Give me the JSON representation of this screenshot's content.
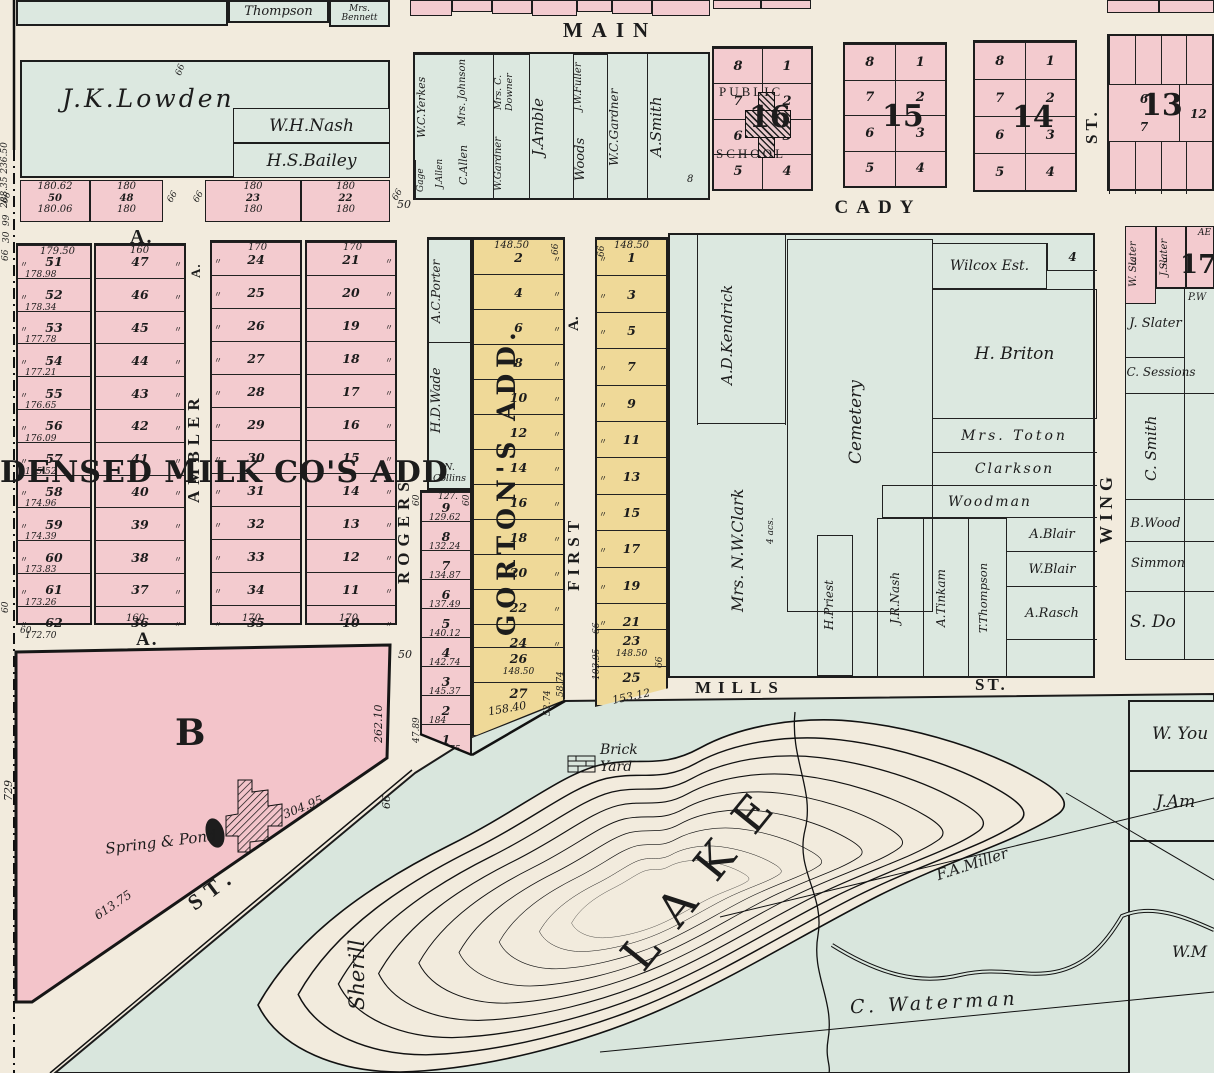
{
  "streets": {
    "main": "MAIN",
    "cady": "CADY",
    "mills": "MILLS",
    "mills_st": "ST.",
    "st13": "ST.",
    "wing": "WING",
    "rogers": "ROGERS",
    "ambler": "AMBLER",
    "ambler_a": "A.",
    "first": "FIRST",
    "first_a": "A.",
    "a_top": "A.",
    "a_bottom": "A.",
    "b_st": "ST."
  },
  "top": {
    "thompson": "Thompson",
    "bennett": "Mrs. Bennett"
  },
  "lowden": {
    "main": "J.K.Lowden",
    "nash": "W.H.Nash",
    "bailey": "H.S.Bailey",
    "lots": [
      {
        "t": "180.62",
        "n": "50",
        "b": "180.06"
      },
      {
        "t": "180",
        "n": "48",
        "b": "180"
      },
      {
        "t": "180",
        "n": "23",
        "b": "180"
      },
      {
        "t": "180",
        "n": "22",
        "b": "180"
      }
    ],
    "m66a": "66",
    "m66b": "66",
    "m66c": "66",
    "m66d": "66",
    "m66e": "66",
    "m50": "50"
  },
  "mainBlock": {
    "yerkes": "W.C.Yerkes",
    "gage": "Gage",
    "jallen": "J.Allen",
    "johnson": "Mrs. Johnson",
    "callen": "C.Allen",
    "downer": "Mrs. C. Downer",
    "wgardner": "W.Gardner",
    "amble": "J.Amble",
    "fuller": "J.W.Fuller",
    "woods": "Woods",
    "wcgardner": "W.C.Gardner",
    "smith": "A.Smith",
    "n8": "8"
  },
  "block16": {
    "big": "16",
    "pub": "PUBLIC",
    "sch": "SCHOOL",
    "rows": [
      [
        "8",
        "1"
      ],
      [
        "7",
        "2"
      ],
      [
        "6",
        "3"
      ],
      [
        "5",
        "4"
      ]
    ]
  },
  "block15": {
    "big": "15",
    "rows": [
      [
        "8",
        "1"
      ],
      [
        "7",
        "2"
      ],
      [
        "6",
        "3"
      ],
      [
        "5",
        "4"
      ]
    ]
  },
  "block14": {
    "big": "14",
    "rows": [
      [
        "8",
        "1"
      ],
      [
        "7",
        "2"
      ],
      [
        "6",
        "3"
      ],
      [
        "5",
        "4"
      ]
    ]
  },
  "block13": {
    "big": "13",
    "top": [
      "5",
      "4",
      "3",
      "2"
    ],
    "m6": "6",
    "m7": "7",
    "m12": "12",
    "bot": [
      "8",
      "9",
      "10",
      "11"
    ]
  },
  "left": {
    "col1Top": "179.50",
    "col1": [
      {
        "n": "51",
        "m": "178.98"
      },
      {
        "n": "52",
        "m": "178.34"
      },
      {
        "n": "53",
        "m": "177.78"
      },
      {
        "n": "54",
        "m": "177.21"
      },
      {
        "n": "55",
        "m": "176.65"
      },
      {
        "n": "56",
        "m": "176.09"
      },
      {
        "n": "57",
        "m": "175.52"
      },
      {
        "n": "58",
        "m": "174.96"
      },
      {
        "n": "59",
        "m": "174.39"
      },
      {
        "n": "60",
        "m": "173.83"
      },
      {
        "n": "61",
        "m": "173.26"
      },
      {
        "n": "62",
        "m": "172.70"
      }
    ],
    "col2Top": "160",
    "col2Bottom": "160",
    "col2": [
      "47",
      "46",
      "45",
      "44",
      "43",
      "42",
      "41",
      "40",
      "39",
      "38",
      "37",
      "36"
    ],
    "col3Top": "170",
    "col3Bottom": "170",
    "col3": [
      "24",
      "25",
      "26",
      "27",
      "28",
      "29",
      "30",
      "31",
      "32",
      "33",
      "34",
      "35"
    ],
    "col4Top": "170",
    "col4Bottom": "170",
    "col4": [
      "21",
      "20",
      "19",
      "18",
      "17",
      "16",
      "15",
      "14",
      "13",
      "12",
      "11",
      "10"
    ],
    "bigAdd": "DENSED MILK CO'S ADD"
  },
  "edge": {
    "a": "288.35 236.50",
    "b": "99",
    "c": "30",
    "d": "66",
    "e": "66",
    "f": "60",
    "g": "60"
  },
  "porterStrip": {
    "porter": "A.C.Porter",
    "wade": "H.D.Wade",
    "collins": "N. Collins",
    "lots": [
      {
        "t": "127.",
        "n": "9",
        "m": "129.62"
      },
      {
        "n": "8",
        "m": "132.24"
      },
      {
        "n": "7",
        "m": "134.87"
      },
      {
        "n": "6",
        "m": "137.49"
      },
      {
        "n": "5",
        "m": "140.12"
      },
      {
        "n": "4",
        "m": "142.74"
      },
      {
        "n": "3",
        "m": "145.37"
      },
      {
        "n": "2",
        "m": "184"
      },
      {
        "n": "1",
        "m": "155.75"
      }
    ],
    "m4789": "47.89",
    "m60": "60",
    "m60b": "60"
  },
  "gortons": {
    "name": "GORTON'S ADD.",
    "top": "148.50",
    "m66": "66",
    "lots": [
      "2",
      "4",
      "6",
      "8",
      "10",
      "12",
      "14",
      "16",
      "18",
      "20",
      "22",
      "24"
    ],
    "lot26": "26",
    "m26": "148.50",
    "lot27": "27",
    "m27": "158.40",
    "m5874": "58.74",
    "m5274": "52.74"
  },
  "strip2": {
    "top": "148.50",
    "m66l": "66",
    "lots": [
      "1",
      "3",
      "5",
      "7",
      "9",
      "11",
      "13",
      "15",
      "17",
      "19",
      "21"
    ],
    "lot23": "23",
    "m23": "148.50",
    "m66b": "66",
    "lot25": "25",
    "m25": "153.12",
    "m10395": "103.95",
    "m66r": "66"
  },
  "estate": {
    "kendrick": "A.D.Kendrick",
    "cemetery": "Cemetery",
    "clark": "Mrs. N.W.Clark",
    "acs": "4 acs.",
    "priest": "H.Priest",
    "jrnash": "J.R.Nash",
    "tinkam": "A.Tinkam",
    "tthompson": "T.Thompson",
    "wilcox": "Wilcox Est.",
    "n4": "4",
    "briton": "H. Briton",
    "toton": "Mrs. Toton",
    "clarkson": "Clarkson",
    "woodman": "Woodman",
    "ablair": "A.Blair",
    "wblair": "W.Blair",
    "arasch": "A.Rasch"
  },
  "farRight": {
    "wslater": "W. Slater",
    "n3": "3",
    "jslater": "J.Slater",
    "n2": "2",
    "n17": "17",
    "ae": "AE",
    "pw": "P.W",
    "jslater2": "J. Slater",
    "sessions": "C. Sessions",
    "csmith": "C. Smith",
    "slivers": [
      "C.",
      "A.",
      "C.",
      "C.",
      "B."
    ],
    "bwood": "B.Wood",
    "simmon": "Simmon",
    "sdo": "S. Do",
    "wyou": "W. You",
    "jam": "J.Am",
    "wm": "W.M"
  },
  "bottom": {
    "b": "B",
    "spring": "Spring & Pond",
    "m30495": "304.95",
    "m61375": "613.75",
    "m26210": "262.10",
    "m66": "66",
    "m729": "729",
    "m50": "50",
    "sherill": "Sherill",
    "brick1": "Brick",
    "brick2": "Yard",
    "lake": "LAKE",
    "miller": "F.A.Miller",
    "waterman": "C. Waterman"
  },
  "misc": {
    "ditto": "〃"
  }
}
